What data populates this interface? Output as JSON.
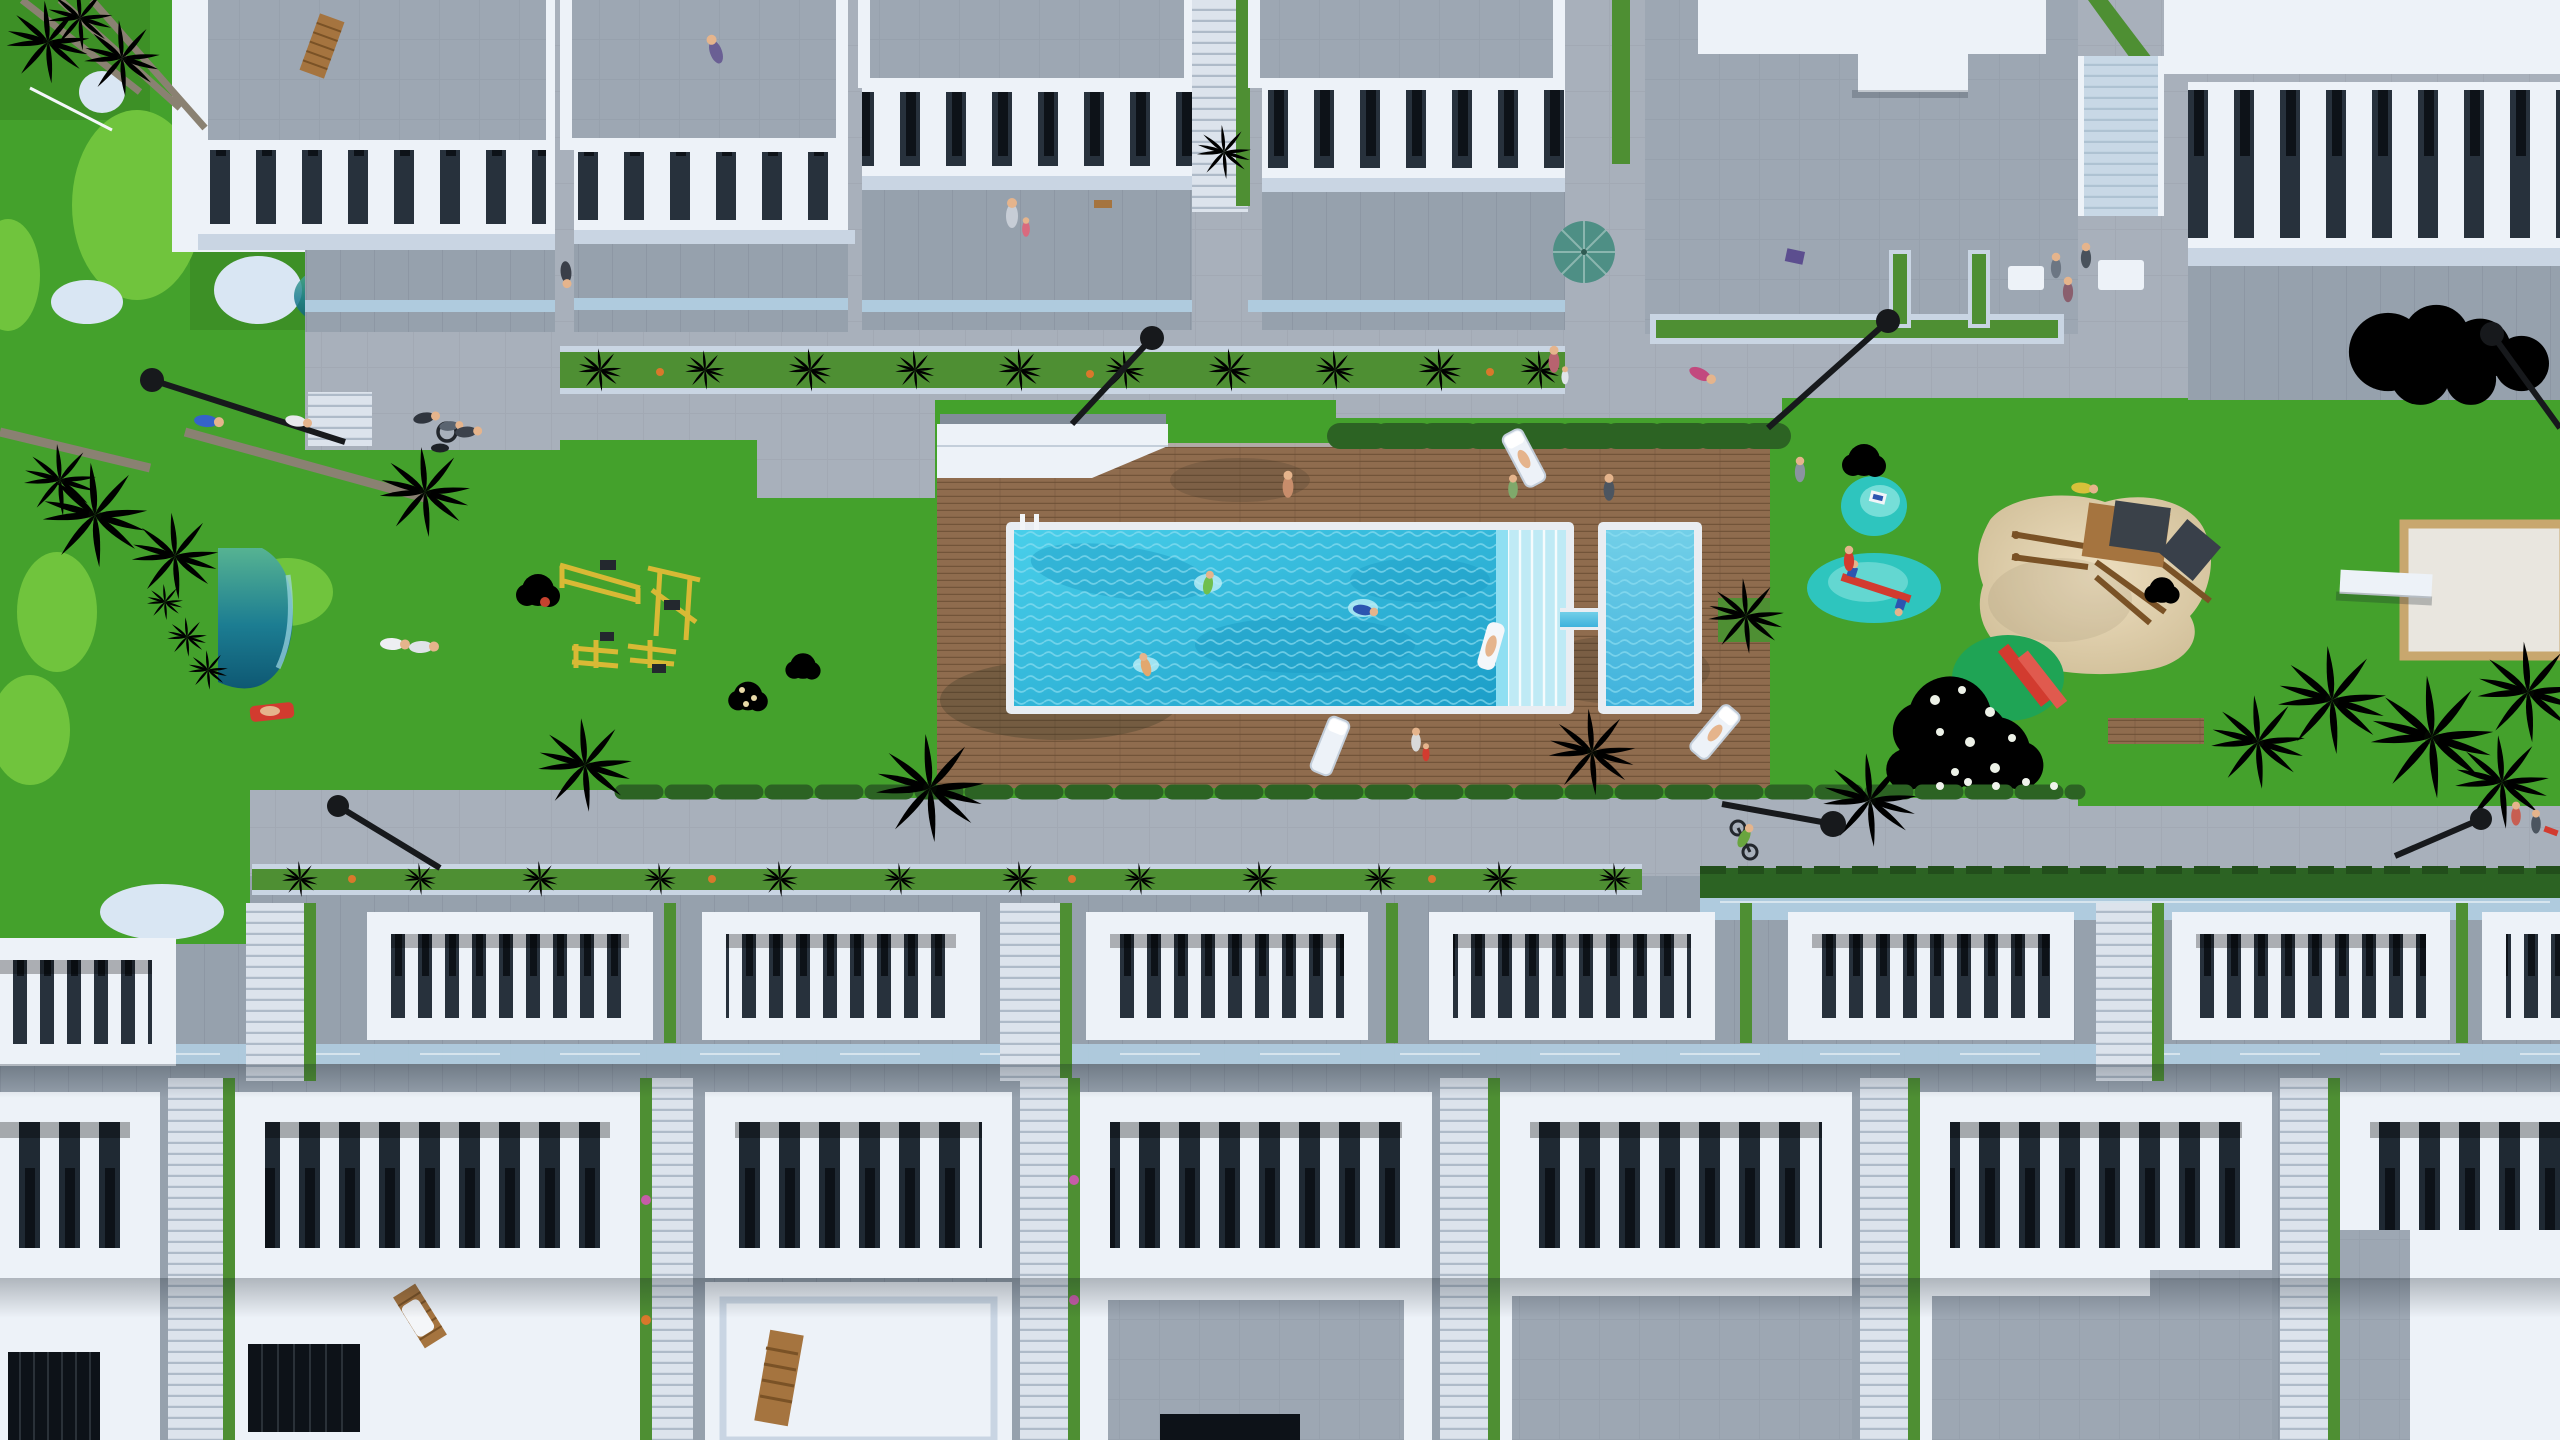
{
  "meta": {
    "title": "Aerial top-down 3D architectural rendering of a residential resort complex with communal pool, gardens, playground and townhouse rows",
    "view": "top-down aerial",
    "render_type": "architectural visualization"
  },
  "palette": {
    "lawn": "#44A12C",
    "lawn_dark": "#35801F",
    "golf_light": "#70C43D",
    "pond_pale": "#D9E6F3",
    "pave": "#A8B0BB",
    "pave_line": "#9CA4AF",
    "roofdeck": "#9DA7B3",
    "roofdeck_line": "#939DA9",
    "facade": "#96A1AD",
    "facade_dark": "#828D99",
    "white_hi": "#EDF2F8",
    "white_lo": "#C9D5E3",
    "opening_dark": "#27313C",
    "opening_darker": "#1F2933",
    "window_black": "#0D1218",
    "glass": "#AFCBDE",
    "plank": "#8F6C4E",
    "plank_line": "#6A4D33",
    "pool_light": "#8FDFF2",
    "coping": "#E9EDF2",
    "sand_edge": "#C8A76E",
    "splash": "#2EC5BE",
    "splash_light": "#8FE6E0",
    "hedge": "#2C6323",
    "palm_dark": "#33611F",
    "palm_mid": "#4E8F33",
    "palm_light": "#73B247",
    "trunk": "#8A8172",
    "lamp": "#17191C",
    "umbrella": "#4E8F85",
    "red": "#D23B2F",
    "emerald": "#1FA455",
    "yellow_gym": "#D8B935",
    "wood": "#A5743F",
    "wood_dark": "#7A5226",
    "skin": "#E5B48C"
  },
  "scene": {
    "top_row_buildings": {
      "count": 6,
      "style": "white multi-storey blocks, rooftop stone decks, white balustrade balcony bands over dark openings, glass rails, stair gaps with green strips",
      "features": [
        "rooftop deck chair",
        "rooftop selfie person",
        "teal patio umbrella",
        "white pergola slab",
        "planter troughs with small palms",
        "glass staircase (right block)"
      ]
    },
    "central_garden": {
      "lawn": "large green communal garden strip",
      "golf_area": {
        "light_green_patches": 5,
        "pale_ponds": 4,
        "flag_pole": 1
      },
      "teal_pond": "D-shaped gradient pond with beach entry",
      "outdoor_gym_machines": 4,
      "palm_trees_approx": 24,
      "street_lamps": 7
    },
    "pool_complex": {
      "deck": "wooden plank sun deck",
      "main_pool": {
        "shape": "rectangular",
        "steps": 6,
        "ladder": 1,
        "swimmers": 3,
        "float_rider": 1
      },
      "kids_pool": {
        "shape": "small rectangle",
        "connected_by": "narrow water channel"
      },
      "pergola": "white angled shade slab at deck corner",
      "sun_loungers": 3,
      "hedge_row": "dark hedge along deck top edge"
    },
    "playground": {
      "splash_pads": 2,
      "rocking_toy": 1,
      "seesaw": {
        "colors": [
          "red",
          "blue"
        ],
        "riders": 2
      },
      "sand_pit": "organic shaped sand area",
      "climbing_structure": "wooden frame with two dark grey cube roofs",
      "slide": {
        "color": "red",
        "on": "emerald mound"
      },
      "flower_bush": "large white-flowering shrub",
      "boules_pad": "pale court with wooden edge and white bench"
    },
    "bottom_rows": {
      "row1_pergola_blocks": 8,
      "row2_pergola_blocks": 7,
      "style": "white frames with white slats over dark roof terraces, glass strips, stair alleys with green planting strips",
      "roof_level": [
        "white flat roofs",
        "grey stone decks",
        "dark solar panels",
        "wooden lounger",
        "wooden bench"
      ]
    },
    "people": [
      {
        "activity": "taking selfie",
        "location": "rooftop T2"
      },
      {
        "activity": "walking",
        "location": "gap between top blocks"
      },
      {
        "activity": "mother with child",
        "location": "terrace T3"
      },
      {
        "activity": "jogging",
        "location": "upper walkway"
      },
      {
        "activity": "mother with child",
        "location": "upper walkway west"
      },
      {
        "activity": "sitting at table",
        "location": "patio zone"
      },
      {
        "activity": "wheelchair user with companion and dog",
        "location": "west path"
      },
      {
        "activity": "lying on grass",
        "location": "west lawn"
      },
      {
        "activity": "couple strolling",
        "location": "central lawn"
      },
      {
        "activity": "sunbathing on red lounger",
        "location": "lawn near promenade"
      },
      {
        "activity": "walking on deck",
        "location": "pool deck"
      },
      {
        "activity": "standing by lounger",
        "location": "pool deck"
      },
      {
        "activity": "swimming x3",
        "location": "main pool"
      },
      {
        "activity": "riding float",
        "location": "pool steps"
      },
      {
        "activity": "sunbathing x2",
        "location": "deck loungers"
      },
      {
        "activity": "child in red",
        "location": "deck south edge"
      },
      {
        "activity": "standing",
        "location": "playground"
      },
      {
        "activity": "walking",
        "location": "playground lawn"
      },
      {
        "activity": "riding seesaw x2",
        "location": "splash pad"
      },
      {
        "activity": "cycling",
        "location": "south promenade"
      },
      {
        "activity": "pair with scooter",
        "location": "south-east corner"
      }
    ]
  }
}
